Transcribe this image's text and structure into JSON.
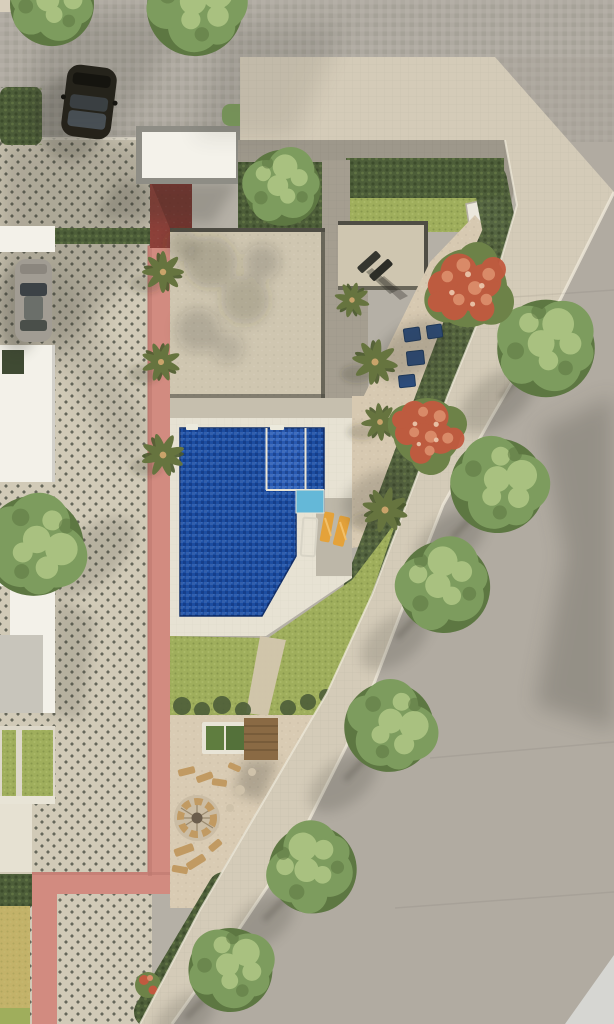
{
  "meta": {
    "title": "Aerial top-view architectural rendering: villa plot with pool, driveway, curved street",
    "view": "top-down 3d render",
    "canvas": {
      "width": 614,
      "height": 1024
    }
  },
  "colors": {
    "road": "#b5b0a6",
    "road_diag": "#a8a399",
    "road_light_corner": "#d6d6d2",
    "sidewalk": "#d8cfbc",
    "curb": "#efe9da",
    "driveway": "#cdc6b2",
    "driveway_dot": "#53564a",
    "pink_path": "#d28b80",
    "pink_dark": "#b9756c",
    "maroon_wall": "#8c4039",
    "carport": "#f4f2ea",
    "frame_gray": "#8e8d85",
    "roof": "#cfc6b0",
    "roof_line": "#4f4d44",
    "patio": "#a8a193",
    "wall": "#a19b8e",
    "hedge": "#4d5e39",
    "lawn": "#9fae5c",
    "tree_dark": "#5d7742",
    "tree_mid": "#7d9c5e",
    "tree_light": "#a9c180",
    "palm": "#66743f",
    "palm_dark": "#4c5a2e",
    "flower_red": "#c2593f",
    "flower_pink": "#d98a68",
    "flower_green": "#6d8248",
    "pool_deep": "#1c4da1",
    "pool_spa": "#2a5cb4",
    "pool_shallow": "#64b8d8",
    "pool_edge": "#12306b",
    "deck": "#eae5d6",
    "deck_gray": "#bdb7a8",
    "deck_strip": "#c6bfae",
    "sand": "#d7c9b1",
    "terrace": "#d9cbb3",
    "wood": "#8a6a44",
    "wood_light": "#c19a62",
    "yellow_lounger": "#e4a23a",
    "blue_lounger": "#2c4d7e",
    "car_black": "#242119",
    "car_glass": "#3c4246",
    "car_silver": "#a19c93",
    "white_building": "#f3f1e9",
    "gray_building": "#c8c5bb",
    "courtyard_green": "#3f4a33",
    "dry_lawn": "#c3b269",
    "kitchen_white": "#ebe7dc",
    "shadow": "#33322b",
    "flower_yellow": "#d8a84a"
  },
  "scene": {
    "objects": [
      "top-street",
      "diagonal-street",
      "sidewalk-band",
      "paver-driveway",
      "black-car",
      "silver-car",
      "carport-roof",
      "pink-garden-path",
      "maroon-wall",
      "villa-main-roof",
      "villa-secondary-roof",
      "roof-lounge-chairs",
      "courtyard-patio",
      "stone-path",
      "boundary-wall",
      "garden-hedge",
      "garden-lawn",
      "garden-tree",
      "outdoor-kitchen",
      "hedge-blue-loungers",
      "pool-deck",
      "swimming-pool",
      "pool-spa",
      "pool-shallow-step",
      "pool-ladders",
      "yellow-loungers",
      "pool-lawn",
      "gravel-terrace",
      "green-table",
      "wood-daybed",
      "log-benches",
      "fire-pit-circle",
      "bottom-benches",
      "bottom-hedge-strip",
      "street-trees",
      "palm-trees",
      "flowering-trees",
      "neighbor-buildings",
      "left-garden-strips",
      "dry-lawn-patch"
    ],
    "counts": {
      "street_trees": 6,
      "palms": 6,
      "flowering_trees": 2,
      "cars": 2,
      "blue_loungers": 4,
      "yellow_loungers": 2
    }
  }
}
